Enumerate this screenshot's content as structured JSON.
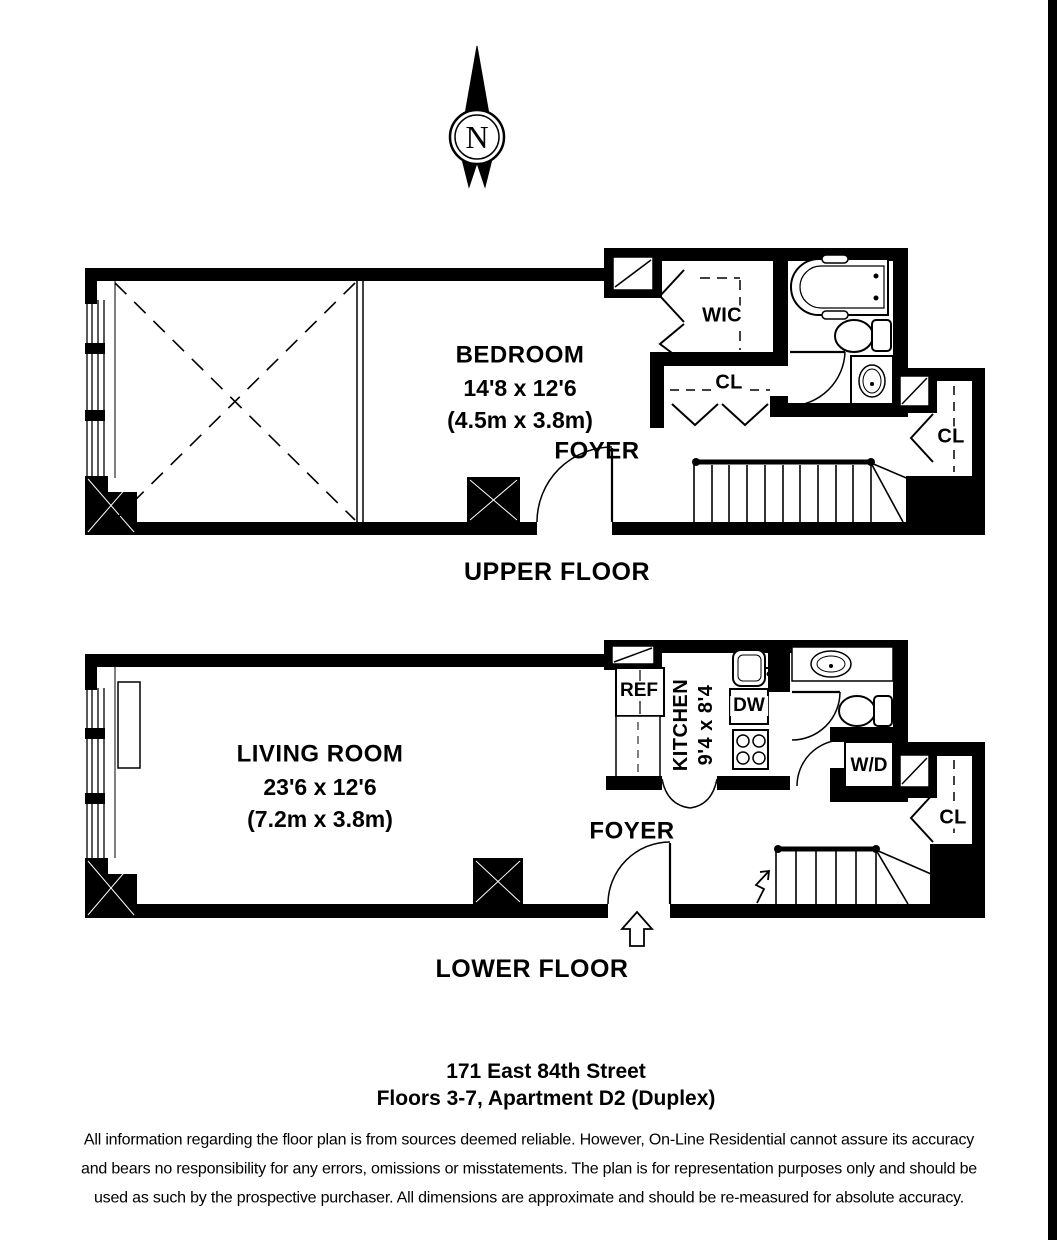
{
  "compass": {
    "north_label": "N"
  },
  "upper_floor": {
    "caption": "UPPER FLOOR",
    "bedroom": {
      "name": "BEDROOM",
      "dimensions": "14'8 x 12'6",
      "dimensions_metric": "(4.5m x 3.8m)"
    },
    "foyer_label": "FOYER",
    "walk_in_closet_label": "WIC",
    "closet_label": "CL",
    "right_closet_label": "CL"
  },
  "lower_floor": {
    "caption": "LOWER FLOOR",
    "living_room": {
      "name": "LIVING ROOM",
      "dimensions": "23'6 x 12'6",
      "dimensions_metric": "(7.2m x 3.8m)"
    },
    "kitchen": {
      "name": "KITCHEN",
      "dimensions": "9'4 x 8'4"
    },
    "foyer_label": "FOYER",
    "refrigerator_label": "REF",
    "dishwasher_label": "DW",
    "washer_dryer_label": "W/D",
    "closet_label": "CL"
  },
  "address": {
    "line1": "171 East 84th Street",
    "line2": "Floors 3-7, Apartment D2 (Duplex)"
  },
  "disclaimer": {
    "line1": "All information regarding the floor plan is from sources deemed reliable.  However, On-Line Residential cannot assure its accuracy",
    "line2": "and bears no responsibility for any errors, omissions or misstatements.  The plan is for representation purposes only and should be",
    "line3": "used as such by the prospective purchaser.  All dimensions are approximate and should be re-measured for absolute accuracy."
  },
  "colors": {
    "ink": "#000000",
    "paper": "#ffffff"
  }
}
